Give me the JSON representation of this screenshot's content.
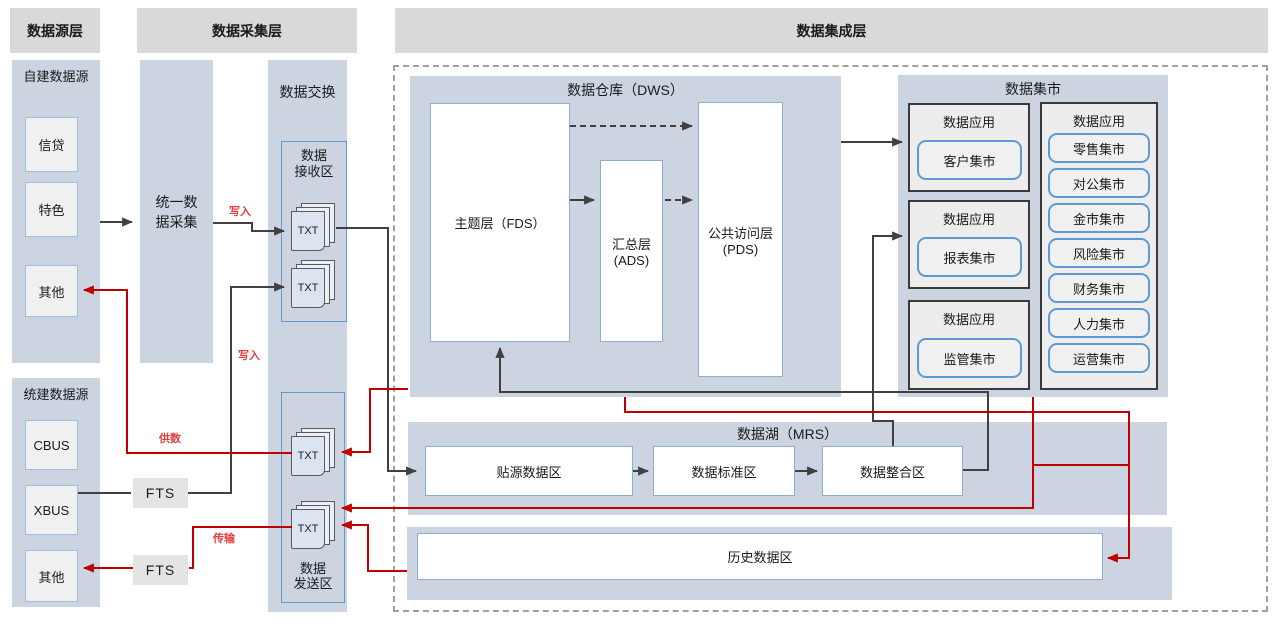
{
  "headers": {
    "source": "数据源层",
    "collection": "数据采集层",
    "integration": "数据集成层"
  },
  "source_layer": {
    "self_built": {
      "title": "自建数据源",
      "items": [
        "信贷",
        "特色",
        "其他"
      ]
    },
    "unified": {
      "title": "统建数据源",
      "items": [
        "CBUS",
        "XBUS",
        "其他"
      ]
    }
  },
  "collection_layer": {
    "unified_collection": "统一数\n据采集",
    "fts_top": "FTS",
    "fts_bottom": "FTS",
    "exchange": {
      "title": "数据交换",
      "receive_label": "数据\n接收区",
      "send_label": "数据\n发送区",
      "txt": "TXT"
    }
  },
  "flow_labels": {
    "write_top": "写入",
    "write_bottom": "写入",
    "supply": "供数",
    "transfer": "传输"
  },
  "integration_layer": {
    "dws": {
      "title": "数据仓库（DWS）",
      "fds": "主题层（FDS）",
      "ads": "汇总层\n(ADS)",
      "pds": "公共访问层\n(PDS)"
    },
    "mart": {
      "title": "数据集市",
      "app_title": "数据应用",
      "left_apps": [
        "客户集市",
        "报表集市",
        "监管集市"
      ],
      "right_apps": [
        "零售集市",
        "对公集市",
        "金市集市",
        "风险集市",
        "财务集市",
        "人力集市",
        "运营集市"
      ]
    },
    "mrs": {
      "title": "数据湖（MRS）",
      "zones": [
        "贴源数据区",
        "数据标准区",
        "数据整合区"
      ]
    },
    "history": "历史数据区"
  },
  "colors": {
    "panel_blue": "#ccd4e2",
    "header_gray": "#d9d9d9",
    "blue_border": "#5b9bd5",
    "line_black": "#404040",
    "line_red": "#c00000"
  }
}
